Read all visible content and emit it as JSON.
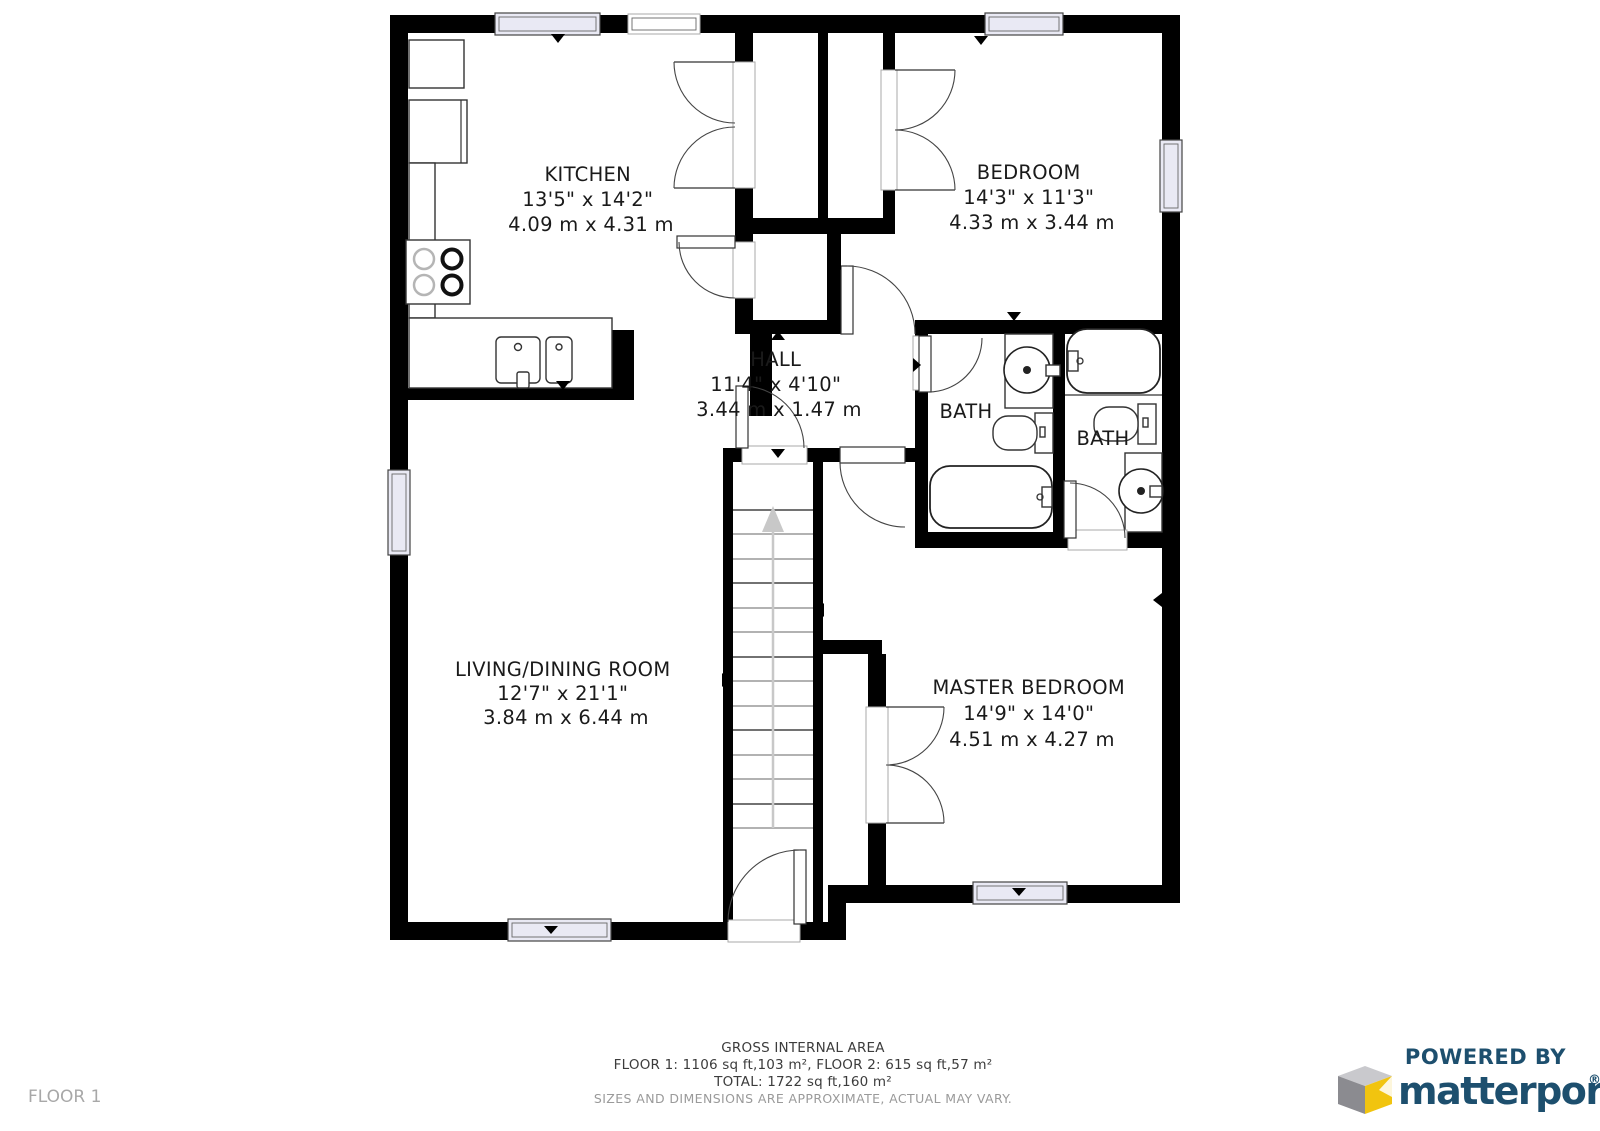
{
  "floor_label": "FLOOR 1",
  "rooms": {
    "kitchen": {
      "name": "KITCHEN",
      "size_imperial": "13'5\" x 14'2\"",
      "size_metric": "4.09 m x 4.31 m"
    },
    "bedroom": {
      "name": "BEDROOM",
      "size_imperial": "14'3\" x 11'3\"",
      "size_metric": "4.33 m x 3.44 m"
    },
    "hall": {
      "name": "HALL",
      "size_imperial": "11'4\" x 4'10\"",
      "size_metric": "3.44 m x 1.47 m"
    },
    "bath_left": {
      "name": "BATH"
    },
    "bath_right": {
      "name": "BATH"
    },
    "living": {
      "name": "LIVING/DINING ROOM",
      "size_imperial": "12'7\" x 21'1\"",
      "size_metric": "3.84 m x 6.44 m"
    },
    "master": {
      "name": "MASTER BEDROOM",
      "size_imperial": "14'9\" x 14'0\"",
      "size_metric": "4.51 m x 4.27 m"
    }
  },
  "footer": {
    "area_title": "GROSS INTERNAL AREA",
    "floors_line": "FLOOR 1: 1106 sq ft,103 m², FLOOR 2: 615 sq ft,57 m²",
    "total_line": "TOTAL: 1722 sq ft,160 m²",
    "disclaimer": "SIZES AND DIMENSIONS ARE APPROXIMATE, ACTUAL MAY VARY."
  },
  "branding": {
    "powered_by": "POWERED BY",
    "name": "matterport",
    "registered": "®"
  },
  "colors": {
    "wall": "#000000",
    "brand_navy": "#1d4f6e",
    "logo_yellow": "#f1c40f",
    "logo_gray_light": "#c9c9cd",
    "logo_gray_dark": "#8b8b90",
    "window_fill": "#e9e9f4"
  }
}
